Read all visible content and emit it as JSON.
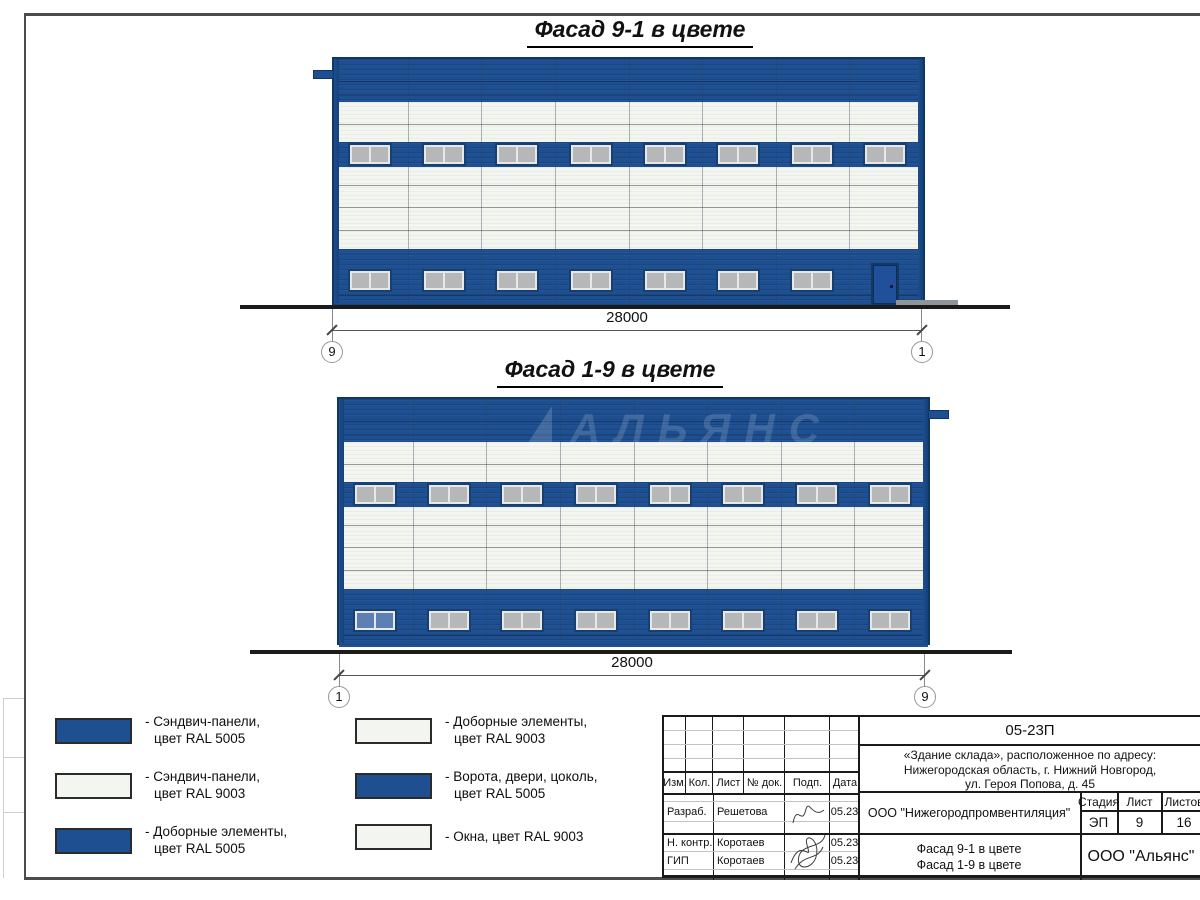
{
  "colors": {
    "ral5005": "#1d4f91",
    "ral9003": "#f3f5f1",
    "outline": "#10375f",
    "glass_grey": "#b6b7b9",
    "glass_blue": "#5d80b4",
    "ground": "#1b1b1b"
  },
  "facades": [
    {
      "name": "facade-9-1",
      "title": "Фасад 9-1 в цвете",
      "dim": "28000",
      "axis_left": "9",
      "axis_right": "1",
      "bays": 8,
      "top_windows": 8,
      "bottom_windows": 7,
      "door": "right",
      "tab": "left",
      "blue_window": null
    },
    {
      "name": "facade-1-9",
      "title": "Фасад 1-9 в цвете",
      "dim": "28000",
      "axis_left": "1",
      "axis_right": "9",
      "bays": 8,
      "top_windows": 8,
      "bottom_windows": 8,
      "door": null,
      "tab": "right",
      "blue_window": 0
    }
  ],
  "watermark": {
    "text": "АЛЬЯНС"
  },
  "legend": {
    "items": [
      {
        "swatch": "blue",
        "lines": [
          "- Сэндвич-панели,",
          "цвет RAL 5005"
        ]
      },
      {
        "swatch": "white",
        "lines": [
          "- Сэндвич-панели,",
          "цвет RAL 9003"
        ]
      },
      {
        "swatch": "blue",
        "lines": [
          "- Доборные элементы,",
          "цвет RAL 5005"
        ]
      },
      {
        "swatch": "white",
        "lines": [
          "- Доборные элементы,",
          "цвет RAL 9003"
        ]
      },
      {
        "swatch": "blue",
        "lines": [
          "- Ворота, двери, цоколь,",
          "цвет RAL 5005"
        ]
      },
      {
        "swatch": "white",
        "lines": [
          "- Окна, цвет RAL 9003"
        ]
      }
    ]
  },
  "titleblock": {
    "doc_number": "05-23П",
    "object": [
      "«Здание склада», расположенное по адресу:",
      "Нижегородская область, г. Нижний Новгород,",
      "ул. Героя Попова, д. 45"
    ],
    "header_cols": [
      "Изм.",
      "Кол.",
      "Лист",
      "№ док.",
      "Подп.",
      "Дата"
    ],
    "signers": [
      {
        "role": "Разраб.",
        "name": "Решетова",
        "date": "05.23"
      },
      {
        "role": "Н. контр.",
        "name": "Коротаев",
        "date": "05.23"
      },
      {
        "role": "ГИП",
        "name": "Коротаев",
        "date": "05.23"
      }
    ],
    "company": "ООО \"Нижегородпромвентиляция\"",
    "stage_label": "Стадия",
    "sheet_label": "Лист",
    "sheets_label": "Листов",
    "stage": "ЭП",
    "sheet": "9",
    "sheets": "16",
    "sheet_title": [
      "Фасад 9-1 в цвете",
      "Фасад 1-9 в цвете"
    ],
    "org": "ООО \"Альянс\""
  }
}
